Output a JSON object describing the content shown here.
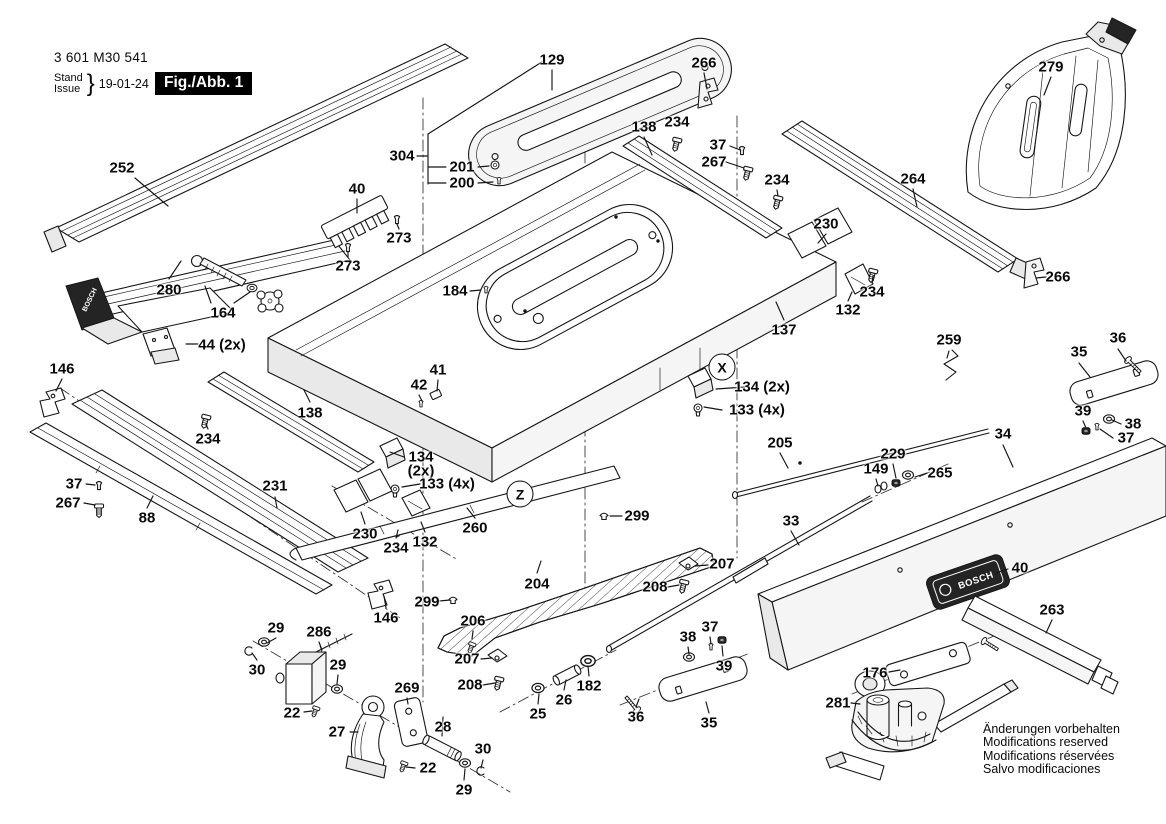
{
  "header": {
    "part_number": "3 601 M30 541",
    "stand_label": "Stand",
    "issue_label": "Issue",
    "issue_date": "19-01-24",
    "figure_label": "Fig./Abb. 1"
  },
  "brand": {
    "name": "BOSCH"
  },
  "footer_note": {
    "line1": "Änderungen vorbehalten",
    "line2": "Modifications reserved",
    "line3": "Modifications réservées",
    "line4": "Salvo modificaciones"
  },
  "diagram": {
    "view_markers": [
      {
        "text": "X",
        "x": 722,
        "y": 367
      },
      {
        "text": "Z",
        "x": 520,
        "y": 494
      }
    ],
    "part_labels": [
      {
        "text": "252",
        "x": 122,
        "y": 168
      },
      {
        "text": "304",
        "x": 402,
        "y": 156
      },
      {
        "text": "201",
        "x": 462,
        "y": 167
      },
      {
        "text": "200",
        "x": 462,
        "y": 183
      },
      {
        "text": "129",
        "x": 552,
        "y": 60
      },
      {
        "text": "266",
        "x": 704,
        "y": 63
      },
      {
        "text": "138",
        "x": 644,
        "y": 127
      },
      {
        "text": "234",
        "x": 677,
        "y": 122
      },
      {
        "text": "37",
        "x": 718,
        "y": 145
      },
      {
        "text": "267",
        "x": 714,
        "y": 162
      },
      {
        "text": "234",
        "x": 777,
        "y": 180
      },
      {
        "text": "279",
        "x": 1051,
        "y": 67
      },
      {
        "text": "264",
        "x": 913,
        "y": 179
      },
      {
        "text": "230",
        "x": 826,
        "y": 224
      },
      {
        "text": "266",
        "x": 1058,
        "y": 277
      },
      {
        "text": "40",
        "x": 357,
        "y": 189
      },
      {
        "text": "273",
        "x": 399,
        "y": 238
      },
      {
        "text": "273",
        "x": 348,
        "y": 266
      },
      {
        "text": "280",
        "x": 169,
        "y": 290
      },
      {
        "text": "164",
        "x": 223,
        "y": 313
      },
      {
        "text": "44 (2x)",
        "x": 222,
        "y": 345
      },
      {
        "text": "146",
        "x": 62,
        "y": 369
      },
      {
        "text": "184",
        "x": 455,
        "y": 291
      },
      {
        "text": "234",
        "x": 872,
        "y": 292
      },
      {
        "text": "132",
        "x": 848,
        "y": 310
      },
      {
        "text": "137",
        "x": 784,
        "y": 330
      },
      {
        "text": "134 (2x)",
        "x": 762,
        "y": 387
      },
      {
        "text": "133 (4x)",
        "x": 757,
        "y": 410
      },
      {
        "text": "259",
        "x": 949,
        "y": 340
      },
      {
        "text": "35",
        "x": 1079,
        "y": 352
      },
      {
        "text": "36",
        "x": 1118,
        "y": 338
      },
      {
        "text": "39",
        "x": 1083,
        "y": 411
      },
      {
        "text": "38",
        "x": 1133,
        "y": 424
      },
      {
        "text": "37",
        "x": 1126,
        "y": 438
      },
      {
        "text": "34",
        "x": 1003,
        "y": 434
      },
      {
        "text": "205",
        "x": 780,
        "y": 443
      },
      {
        "text": "229",
        "x": 893,
        "y": 454
      },
      {
        "text": "149",
        "x": 876,
        "y": 469
      },
      {
        "text": "265",
        "x": 940,
        "y": 473
      },
      {
        "text": "33",
        "x": 791,
        "y": 521
      },
      {
        "text": "138",
        "x": 310,
        "y": 413
      },
      {
        "text": "234",
        "x": 208,
        "y": 439
      },
      {
        "text": "37",
        "x": 74,
        "y": 484
      },
      {
        "text": "267",
        "x": 68,
        "y": 503
      },
      {
        "text": "88",
        "x": 147,
        "y": 518
      },
      {
        "text": "231",
        "x": 275,
        "y": 486
      },
      {
        "text": "41",
        "x": 438,
        "y": 370
      },
      {
        "text": "42",
        "x": 419,
        "y": 385
      },
      {
        "text": "134",
        "x": 421,
        "y": 457
      },
      {
        "text": "(2x)",
        "x": 421,
        "y": 471
      },
      {
        "text": "133 (4x)",
        "x": 447,
        "y": 484
      },
      {
        "text": "230",
        "x": 365,
        "y": 534
      },
      {
        "text": "234",
        "x": 396,
        "y": 548
      },
      {
        "text": "132",
        "x": 425,
        "y": 542
      },
      {
        "text": "260",
        "x": 475,
        "y": 528
      },
      {
        "text": "299",
        "x": 637,
        "y": 516
      },
      {
        "text": "299",
        "x": 427,
        "y": 602
      },
      {
        "text": "204",
        "x": 537,
        "y": 584
      },
      {
        "text": "146",
        "x": 386,
        "y": 618
      },
      {
        "text": "206",
        "x": 473,
        "y": 621
      },
      {
        "text": "207",
        "x": 467,
        "y": 659
      },
      {
        "text": "208",
        "x": 470,
        "y": 685
      },
      {
        "text": "207",
        "x": 722,
        "y": 564
      },
      {
        "text": "208",
        "x": 655,
        "y": 587
      },
      {
        "text": "37",
        "x": 710,
        "y": 627
      },
      {
        "text": "38",
        "x": 688,
        "y": 637
      },
      {
        "text": "39",
        "x": 724,
        "y": 666
      },
      {
        "text": "182",
        "x": 589,
        "y": 686
      },
      {
        "text": "26",
        "x": 564,
        "y": 700
      },
      {
        "text": "25",
        "x": 538,
        "y": 714
      },
      {
        "text": "36",
        "x": 636,
        "y": 717
      },
      {
        "text": "35",
        "x": 709,
        "y": 723
      },
      {
        "text": "29",
        "x": 276,
        "y": 628
      },
      {
        "text": "286",
        "x": 319,
        "y": 632
      },
      {
        "text": "30",
        "x": 257,
        "y": 670
      },
      {
        "text": "29",
        "x": 338,
        "y": 665
      },
      {
        "text": "22",
        "x": 292,
        "y": 713
      },
      {
        "text": "27",
        "x": 337,
        "y": 732
      },
      {
        "text": "269",
        "x": 407,
        "y": 688
      },
      {
        "text": "28",
        "x": 443,
        "y": 727
      },
      {
        "text": "30",
        "x": 483,
        "y": 749
      },
      {
        "text": "22",
        "x": 428,
        "y": 768
      },
      {
        "text": "29",
        "x": 464,
        "y": 790
      },
      {
        "text": "40",
        "x": 1020,
        "y": 568
      },
      {
        "text": "263",
        "x": 1052,
        "y": 610
      },
      {
        "text": "176",
        "x": 875,
        "y": 673
      },
      {
        "text": "281",
        "x": 838,
        "y": 703
      }
    ]
  }
}
